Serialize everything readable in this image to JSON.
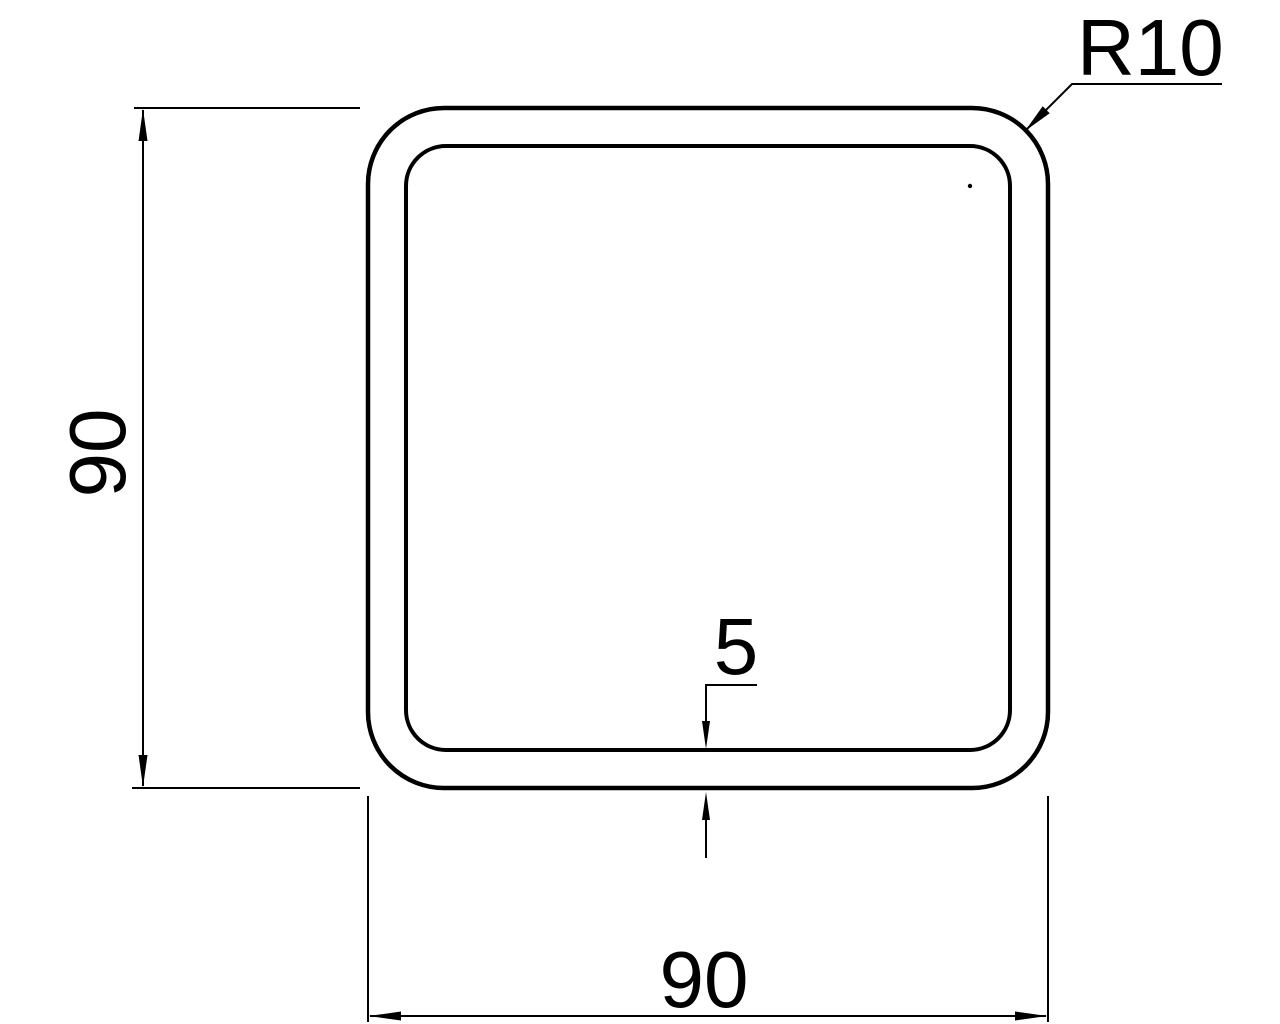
{
  "drawing": {
    "title": "Square hollow section cross-section drawing",
    "colors": {
      "line": "#000000",
      "background": "#ffffff"
    },
    "labels": {
      "height_dim": "90",
      "width_dim": "90",
      "wall_thickness_dim": "5",
      "corner_radius_dim": "R10"
    },
    "geometry": {
      "outer_width": 90,
      "outer_height": 90,
      "wall_thickness": 5,
      "corner_radius_label": "R10"
    }
  }
}
